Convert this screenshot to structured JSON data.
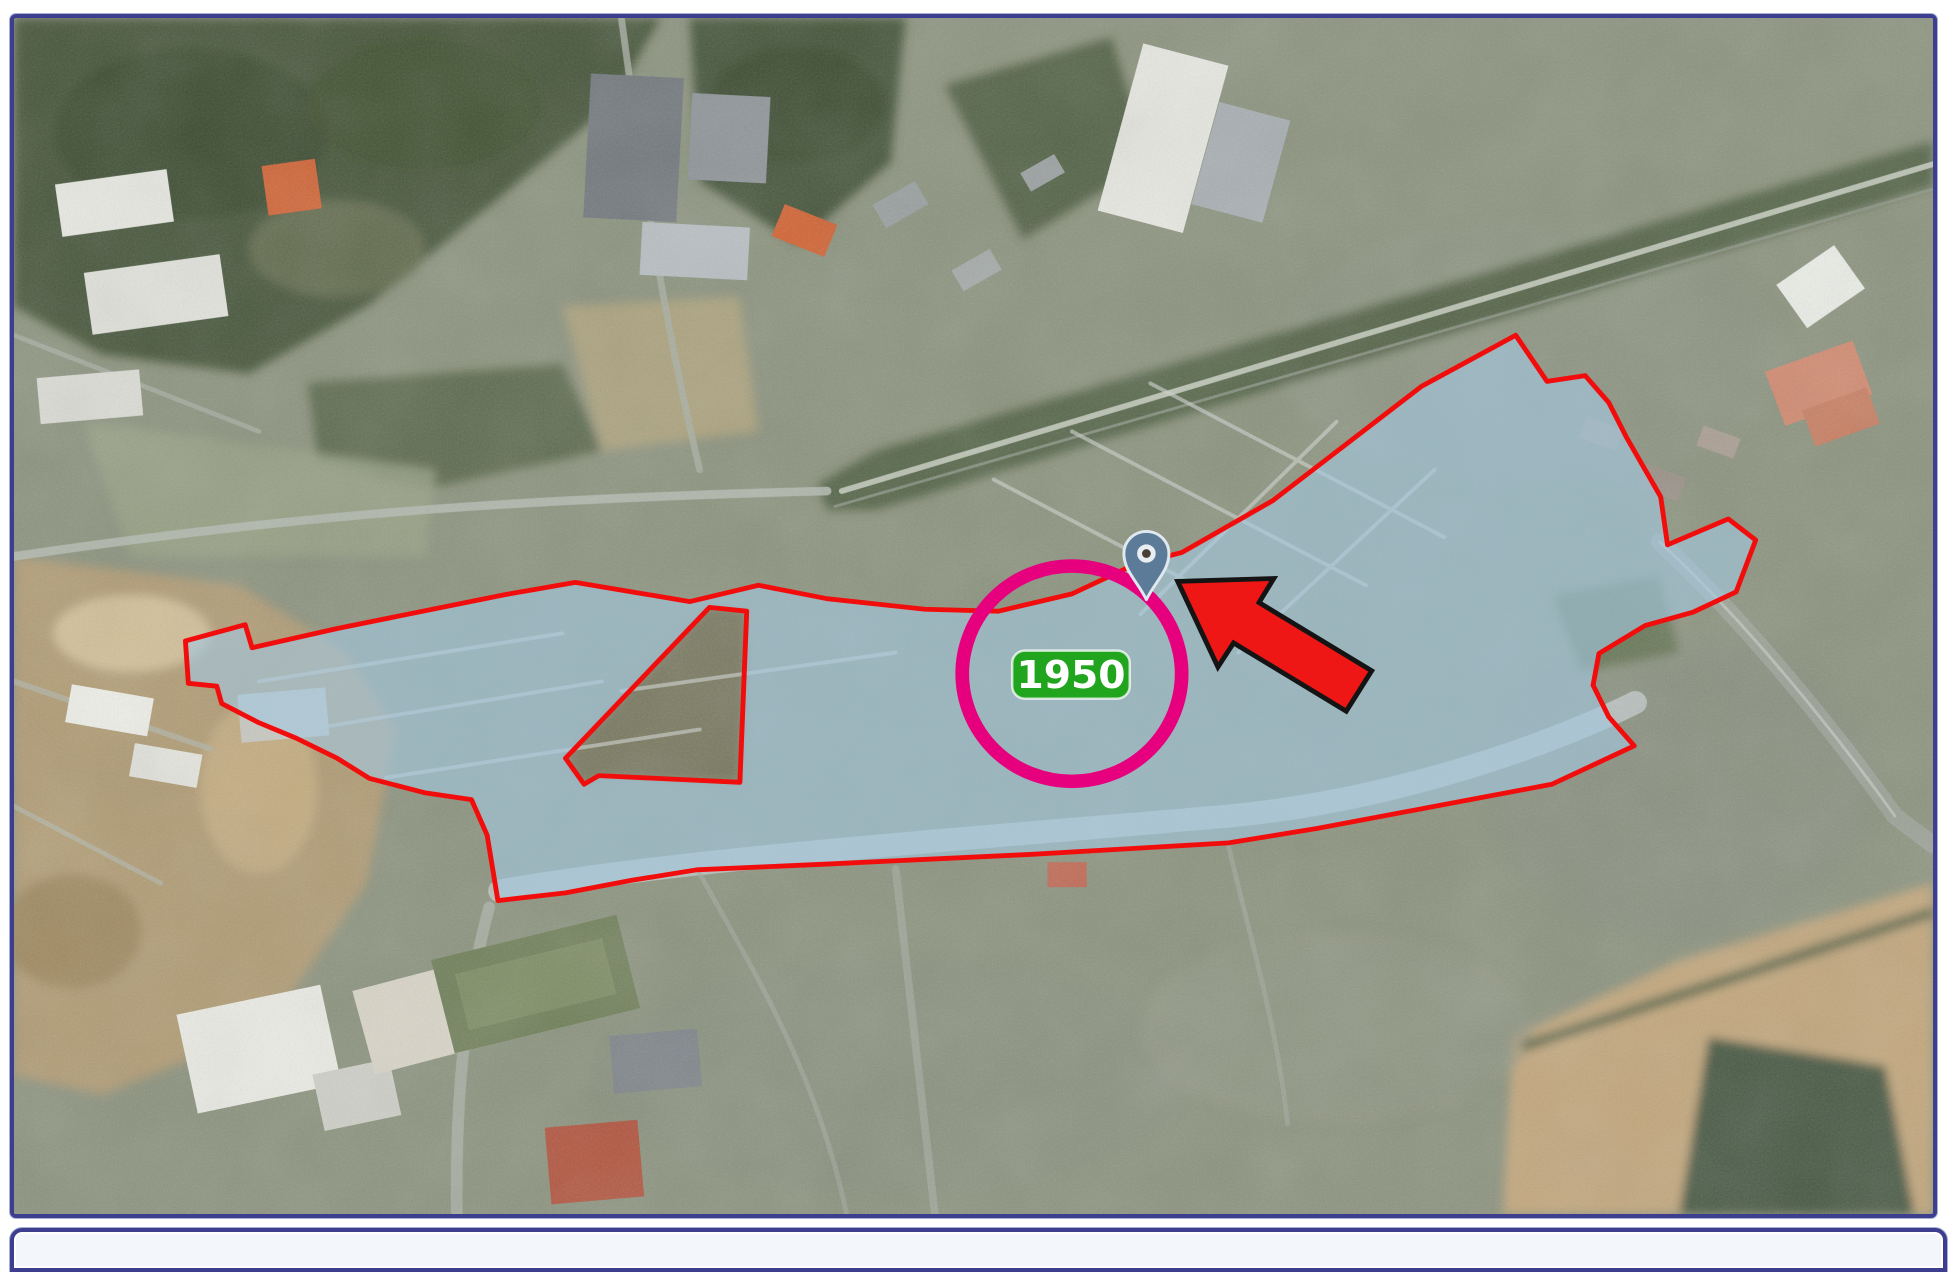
{
  "figure": {
    "description": "Aerial photograph with an outlined urban district highlighted in translucent blue, a magenta highlight circle around a year badge, a map pin marker and a red pointer arrow",
    "frame": {
      "border_color": "#3e3e8e",
      "inner_line_color": "#ccd5ec",
      "page_background": "#ffffff"
    },
    "region": {
      "outline_color": "#f20d0d",
      "fill_color": "#a3c8e0",
      "fill_opacity": "0.62"
    },
    "highlight_circle": {
      "color": "#e6007e"
    },
    "badge": {
      "label": "1950",
      "bg_color": "#22a51e",
      "text_color": "#ffffff"
    },
    "marker_pin": {
      "fill_color": "#5b7b99",
      "outline_color": "#dfe8ee"
    },
    "arrow": {
      "fill_color": "#ef1616",
      "outline_color": "#141414"
    }
  }
}
